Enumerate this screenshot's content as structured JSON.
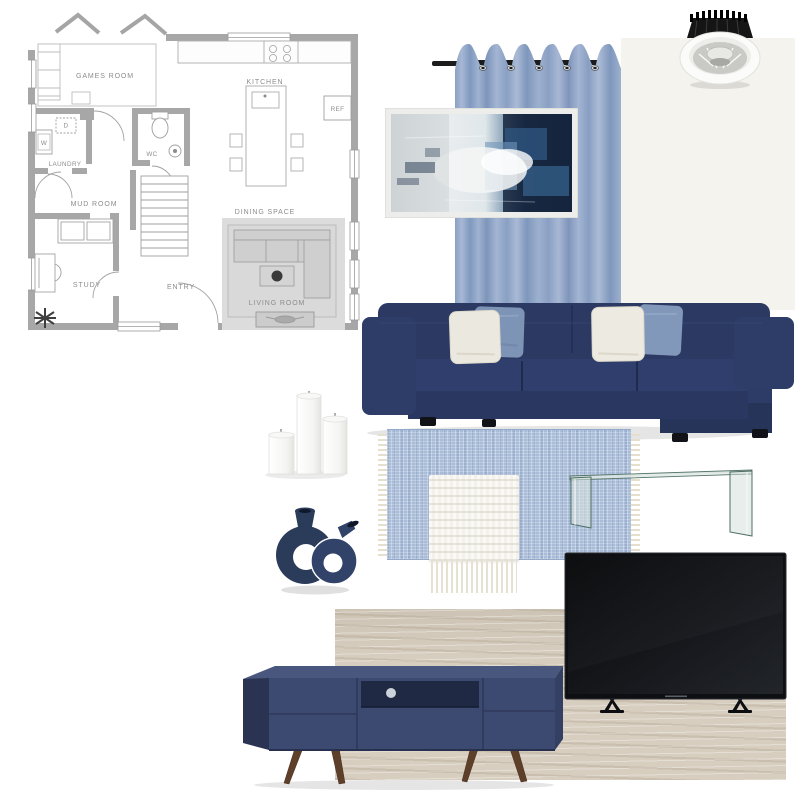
{
  "board": {
    "title": "Blue living room mood board",
    "background": "#ffffff"
  },
  "floor_plan": {
    "labels": {
      "games_room": "GAMES ROOM",
      "kitchen": "KITCHEN",
      "ref": "REF",
      "wc": "WC",
      "laundry": "LAUNDRY",
      "dryer": "D",
      "washer": "W",
      "mud_room": "MUD ROOM",
      "dining_space": "DINING SPACE",
      "study": "STUDY",
      "entry": "ENTRY",
      "living_room": "LIVING ROOM"
    },
    "colors": {
      "wall": "#a7a7a7",
      "line": "#a3a3a3",
      "text": "#8c8c8c",
      "living_room_highlight": "#dcdcdc"
    }
  },
  "items": {
    "curtain": {
      "name": "blue-grommet-curtain",
      "color": "#8fa4c6",
      "rod_color": "#1c1c1c"
    },
    "paint_swatch": {
      "name": "off-white-wall-panel",
      "color": "#f4f3ee"
    },
    "downlight": {
      "name": "recessed-led-downlight",
      "trim_color": "#fbfbfa",
      "heatsink_color": "#151515"
    },
    "painting": {
      "name": "blue-abstract-framed-art",
      "frame_color": "#ededeb"
    },
    "sofa": {
      "name": "navy-sectional-sofa",
      "color": "#2c3a66"
    },
    "cushions": {
      "white": "#ebe8df",
      "blue": "#7e94b6"
    },
    "candles": {
      "name": "white-pillar-candles",
      "color": "#fbfbfa",
      "count": 3
    },
    "vase": {
      "name": "navy-sculptural-double-vase",
      "color": "#2b3b5a"
    },
    "rug": {
      "name": "light-blue-woven-rug",
      "color": "#a9bcd8",
      "fringe_color": "#e6dfcd"
    },
    "throw": {
      "name": "white-knit-throw",
      "color": "#f3f1ea"
    },
    "coffee_table": {
      "name": "bent-glass-coffee-table",
      "edge_color": "#4e6e63"
    },
    "wood_swatch": {
      "name": "light-oak-panel",
      "color": "#d7cec0"
    },
    "tv_unit": {
      "name": "navy-mid-century-tv-unit",
      "color": "#3c4970",
      "leg_color": "#5e3f29"
    },
    "tv": {
      "name": "flat-screen-tv",
      "color": "#0d0f12"
    }
  }
}
